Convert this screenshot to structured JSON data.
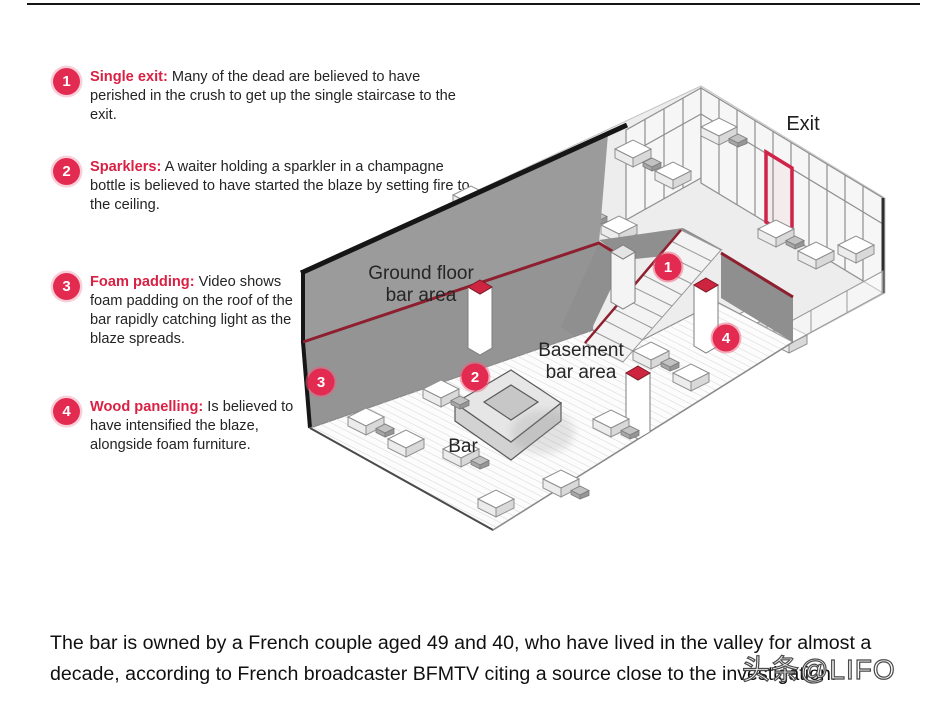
{
  "annotations": [
    {
      "number": "1",
      "title": "Single exit:",
      "text": "Many of the dead are believed to have perished in the crush to get up the single staircase to the exit."
    },
    {
      "number": "2",
      "title": "Sparklers:",
      "text": "A waiter holding a sparkler in a champagne bottle is believed to have started the blaze by setting fire to the ceiling."
    },
    {
      "number": "3",
      "title": "Foam padding:",
      "text": "Video shows foam padding on the roof of the bar rapidly catching light as the blaze spreads."
    },
    {
      "number": "4",
      "title": "Wood panelling:",
      "text": "Is believed to have intensified the blaze, alongside foam furniture."
    }
  ],
  "diagram": {
    "labels": {
      "exit": "Exit",
      "ground_floor_line1": "Ground floor",
      "ground_floor_line2": "bar area",
      "basement_line1": "Basement",
      "basement_line2": "bar area",
      "bar": "Bar"
    },
    "markers": [
      {
        "number": "1"
      },
      {
        "number": "2"
      },
      {
        "number": "3"
      },
      {
        "number": "4"
      }
    ],
    "colors": {
      "marker_red": "#e32b51",
      "trim_red": "#8e1f2e",
      "door_red": "#cf2448",
      "wall_gray": "#949494",
      "floor_light": "#ededed"
    }
  },
  "caption": {
    "text": "The bar is owned by a French couple aged 49 and 40, who have lived in the valley for almost a decade, according to French broadcaster BFMTV citing a source close to the investigation."
  },
  "watermark": {
    "text": "头条@LIFO"
  }
}
